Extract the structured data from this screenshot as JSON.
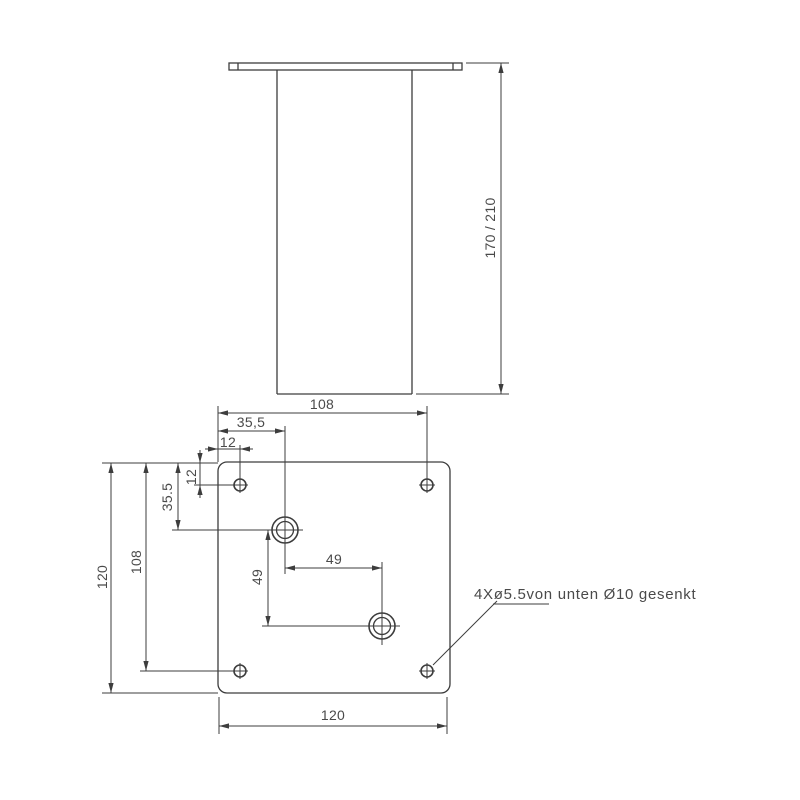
{
  "colors": {
    "line": "#3d3d3d",
    "text": "#4a4a4a",
    "background": "#ffffff"
  },
  "side_view": {
    "height_dim": "170 / 210"
  },
  "plan_view": {
    "dims": {
      "top_hole_span": "108",
      "top_big_hole_offset": "35,5",
      "top_corner_hole_offset": "12",
      "left_plate_size": "120",
      "left_hole_span": "108",
      "left_big_hole_offset": "35.5",
      "left_corner_hole_offset": "12",
      "big_hole_pitch_x": "49",
      "big_hole_pitch_y": "49",
      "bottom_plate_size": "120"
    },
    "note": "4Xø5.5von unten Ø10 gesenkt"
  }
}
